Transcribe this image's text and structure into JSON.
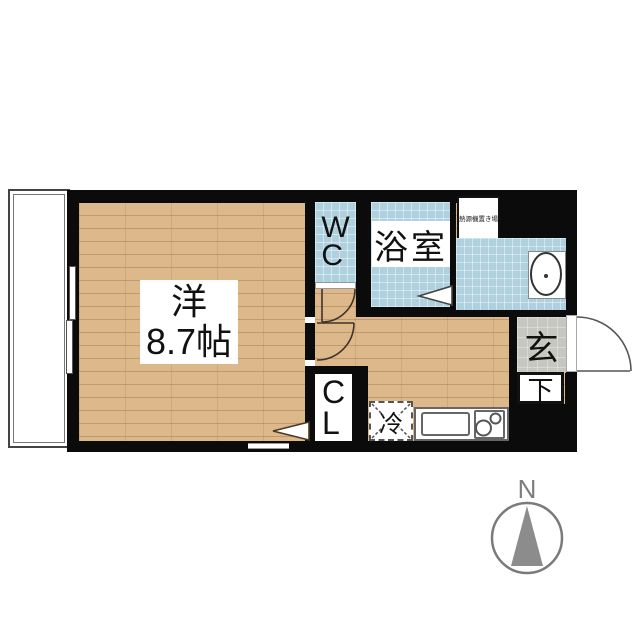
{
  "plan": {
    "main_room": {
      "line1": "洋",
      "line2": "8.7帖"
    },
    "wc": {
      "label": "WC"
    },
    "bath": {
      "label": "浴室"
    },
    "closet": {
      "label": "CL"
    },
    "entrance": {
      "label": "玄"
    },
    "shoe_cabinet": {
      "label": "下"
    },
    "refrigerator": {
      "label": "冷"
    },
    "water_heater": {
      "label": "熱源機置き場"
    },
    "compass": {
      "north": "N"
    },
    "colors": {
      "wall": "#0b0b0b",
      "wood_floor": "#dcb88b",
      "tile_blue": "#aed0df",
      "entrance_gray": "#c7c7c2",
      "compass_gray": "#8c8c8c"
    }
  }
}
